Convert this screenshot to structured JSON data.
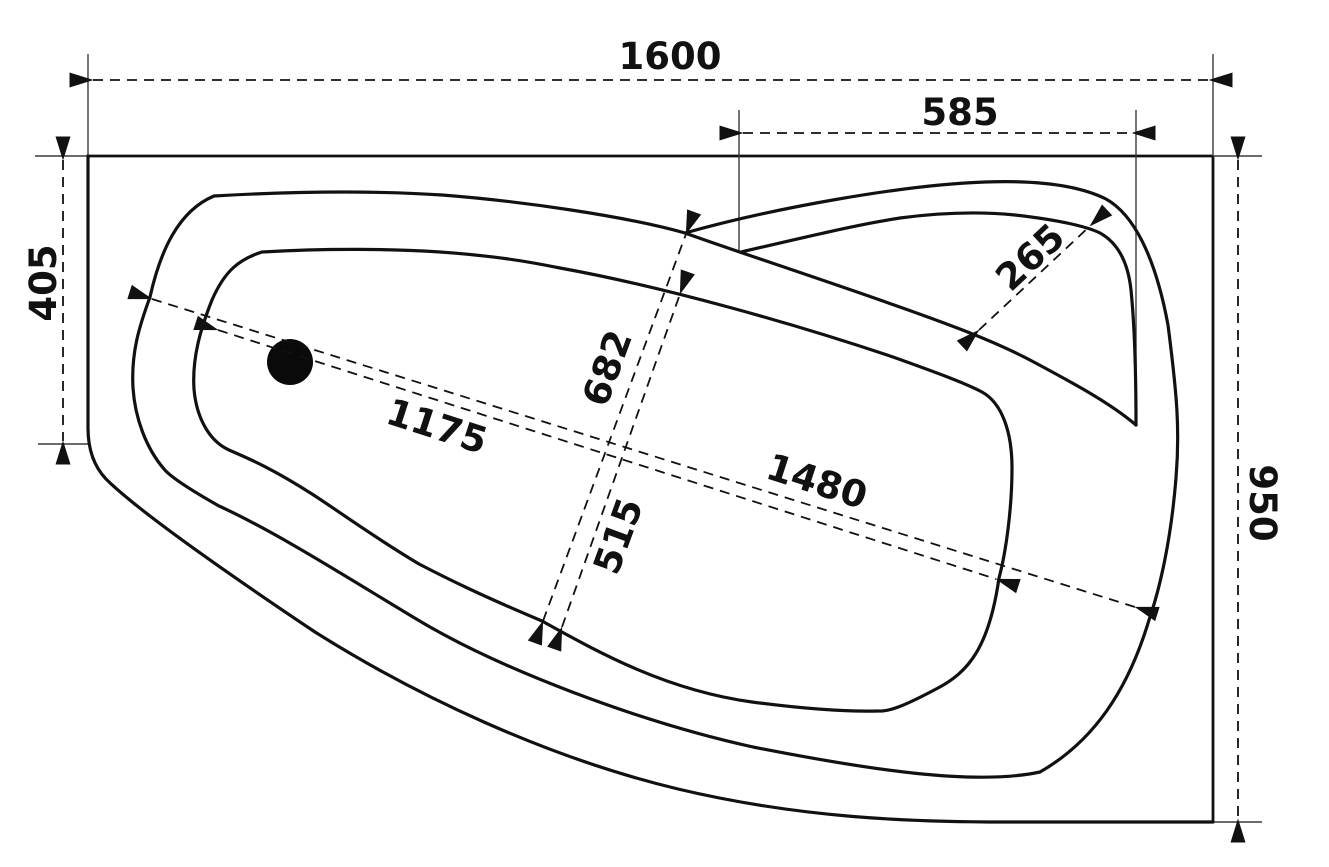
{
  "drawing": {
    "title": "bathtub-top-view-dimension-drawing",
    "background": "#ffffff",
    "line_color": "#111111",
    "dimensions": {
      "d1600": "1600",
      "d585": "585",
      "d405": "405",
      "d265": "265",
      "d682": "682",
      "d515": "515",
      "d1175": "1175",
      "d1480": "1480",
      "d950": "950"
    }
  }
}
